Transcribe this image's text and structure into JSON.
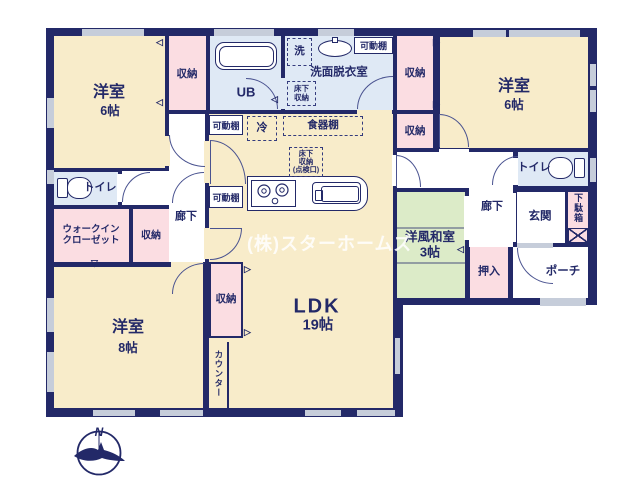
{
  "watermark": "(株)スターホームズ",
  "compass": {
    "north_label": "N"
  },
  "rooms": {
    "bedroom_nw": {
      "name": "洋室",
      "size": "6帖"
    },
    "bedroom_ne": {
      "name": "洋室",
      "size": "6帖"
    },
    "bedroom_sw": {
      "name": "洋室",
      "size": "8帖"
    },
    "ldk": {
      "name": "LDK",
      "size": "19帖"
    },
    "japanese_room": {
      "name": "洋風和室",
      "size": "3帖"
    },
    "unit_bath": {
      "name": "UB"
    },
    "washroom": {
      "name": "洗面脱衣室"
    },
    "toilet": {
      "name": "トイレ"
    },
    "hallway": {
      "name": "廊下"
    },
    "entrance": {
      "name": "玄関"
    },
    "porch": {
      "name": "ポーチ"
    },
    "walk_in_closet": {
      "line1": "ウォークイン",
      "line2": "クローゼット"
    },
    "oshiire": {
      "name": "押入"
    },
    "shoe_cabinet": {
      "name": "下駄箱"
    },
    "counter": {
      "name": "カウンター"
    }
  },
  "storage": {
    "closet": "収納",
    "movable_shelf": "可動棚"
  },
  "fixtures": {
    "washer": "洗",
    "refrigerator": "冷",
    "cupboard": "食器棚",
    "underfloor_storage": {
      "line1": "床下",
      "line2": "収納"
    },
    "underfloor_inspection": {
      "line1": "床下",
      "line2": "収納",
      "line3": "(点検口)"
    }
  },
  "colors": {
    "wall": "#232968",
    "room_floor": "#f8ecca",
    "storage_floor": "#fbdde2",
    "wet_area_floor": "#dfe9f5",
    "tatami_floor": "#dcebc8",
    "window": "#c6cdda"
  }
}
